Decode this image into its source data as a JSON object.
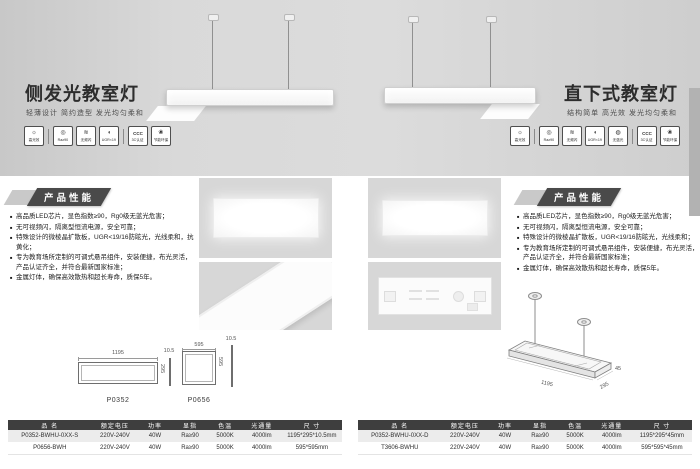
{
  "left": {
    "title": "侧发光教室灯",
    "subtitle": "轻薄设计 简约造型 发光均匀柔和",
    "section_title": "产品性能",
    "bullets": [
      "高品质LED芯片，显色指数≥90，Rg0级无蓝光危害；",
      "无可视频闪，隔离型恒流电源，安全可靠；",
      "特殊设计的微棱晶扩散板，UGR<19/16防眩光，光线柔和，抗黄化；",
      "专为教育场所定制的可调式悬吊组件，安装便捷，布光灵活，产品认证齐全，并符合最新国家标准；",
      "金属灯体，确保高效散热和超长寿命，质保5年。"
    ],
    "icons": [
      {
        "name": "high-efficacy-icon",
        "glyph": "☼",
        "label": "高光效"
      },
      {
        "name": "cri-icon",
        "glyph": "◎",
        "label": "Ra≥90"
      },
      {
        "name": "no-flicker-icon",
        "glyph": "≋",
        "label": "无频闪"
      },
      {
        "name": "anti-glare-icon",
        "glyph": "◖",
        "label": "UGR<19"
      },
      {
        "name": "ccc-cert-icon",
        "glyph": "CCC",
        "label": "3C认证"
      },
      {
        "name": "eco-icon",
        "glyph": "❀",
        "label": "节能环保"
      }
    ],
    "drawing_rect": {
      "model": "P0352",
      "length": "1195",
      "width": "295",
      "thickness": "10.5"
    },
    "drawing_square": {
      "model": "P0656",
      "length": "595",
      "width": "595",
      "thickness": "10.5"
    },
    "table": {
      "headers": [
        "品 名",
        "额定电压",
        "功率",
        "显指",
        "色温",
        "光通量",
        "尺 寸"
      ],
      "rows": [
        [
          "P0352-BWHU-0XX-S",
          "220V-240V",
          "40W",
          "Ra≥90",
          "5000K",
          "4000lm",
          "1195*295*10.5mm"
        ],
        [
          "P0656-BWH",
          "220V-240V",
          "40W",
          "Ra≥90",
          "5000K",
          "4000lm",
          "595*595mm"
        ]
      ]
    }
  },
  "right": {
    "title": "直下式教室灯",
    "subtitle": "结构简单 高光效 发光均匀柔和",
    "section_title": "产品性能",
    "bullets": [
      "高品质LED芯片，显色指数≥90，Rg0级无蓝光危害；",
      "无可视频闪，隔离型恒流电源，安全可靠；",
      "特殊设计的微棱晶扩散板，UGR<19/16防眩光，光线柔和；",
      "专为教育场所定制的可调式悬吊组件，安装便捷，布光灵活，产品认证齐全，并符合最新国家标准；",
      "金属灯体，确保高效散热和超长寿命，质保5年。"
    ],
    "icons": [
      {
        "name": "high-efficacy-icon",
        "glyph": "☼",
        "label": "高光效"
      },
      {
        "name": "cri-icon",
        "glyph": "◎",
        "label": "Ra≥90"
      },
      {
        "name": "no-flicker-icon",
        "glyph": "≋",
        "label": "无频闪"
      },
      {
        "name": "anti-glare-icon",
        "glyph": "◖",
        "label": "UGR<19"
      },
      {
        "name": "no-blue-light-icon",
        "glyph": "◍",
        "label": "无蓝光"
      },
      {
        "name": "ccc-cert-icon",
        "glyph": "CCC",
        "label": "3C认证"
      },
      {
        "name": "eco-icon",
        "glyph": "❀",
        "label": "节能环保"
      }
    ],
    "drawing_iso": {
      "length": "1195",
      "width": "295",
      "height": "45"
    },
    "table": {
      "headers": [
        "品 名",
        "额定电压",
        "功率",
        "显指",
        "色温",
        "光通量",
        "尺 寸"
      ],
      "rows": [
        [
          "P0352-BWHU-0XX-D",
          "220V-240V",
          "40W",
          "Ra≥90",
          "5000K",
          "4000lm",
          "1195*295*45mm"
        ],
        [
          "T3606-BWHU",
          "220V-240V",
          "40W",
          "Ra≥90",
          "5000K",
          "4000lm",
          "595*595*45mm"
        ]
      ]
    }
  },
  "colors": {
    "hero_gray": "#d6d6d6",
    "table_header": "#3e3e3e",
    "badge": "#4a4a4a"
  }
}
